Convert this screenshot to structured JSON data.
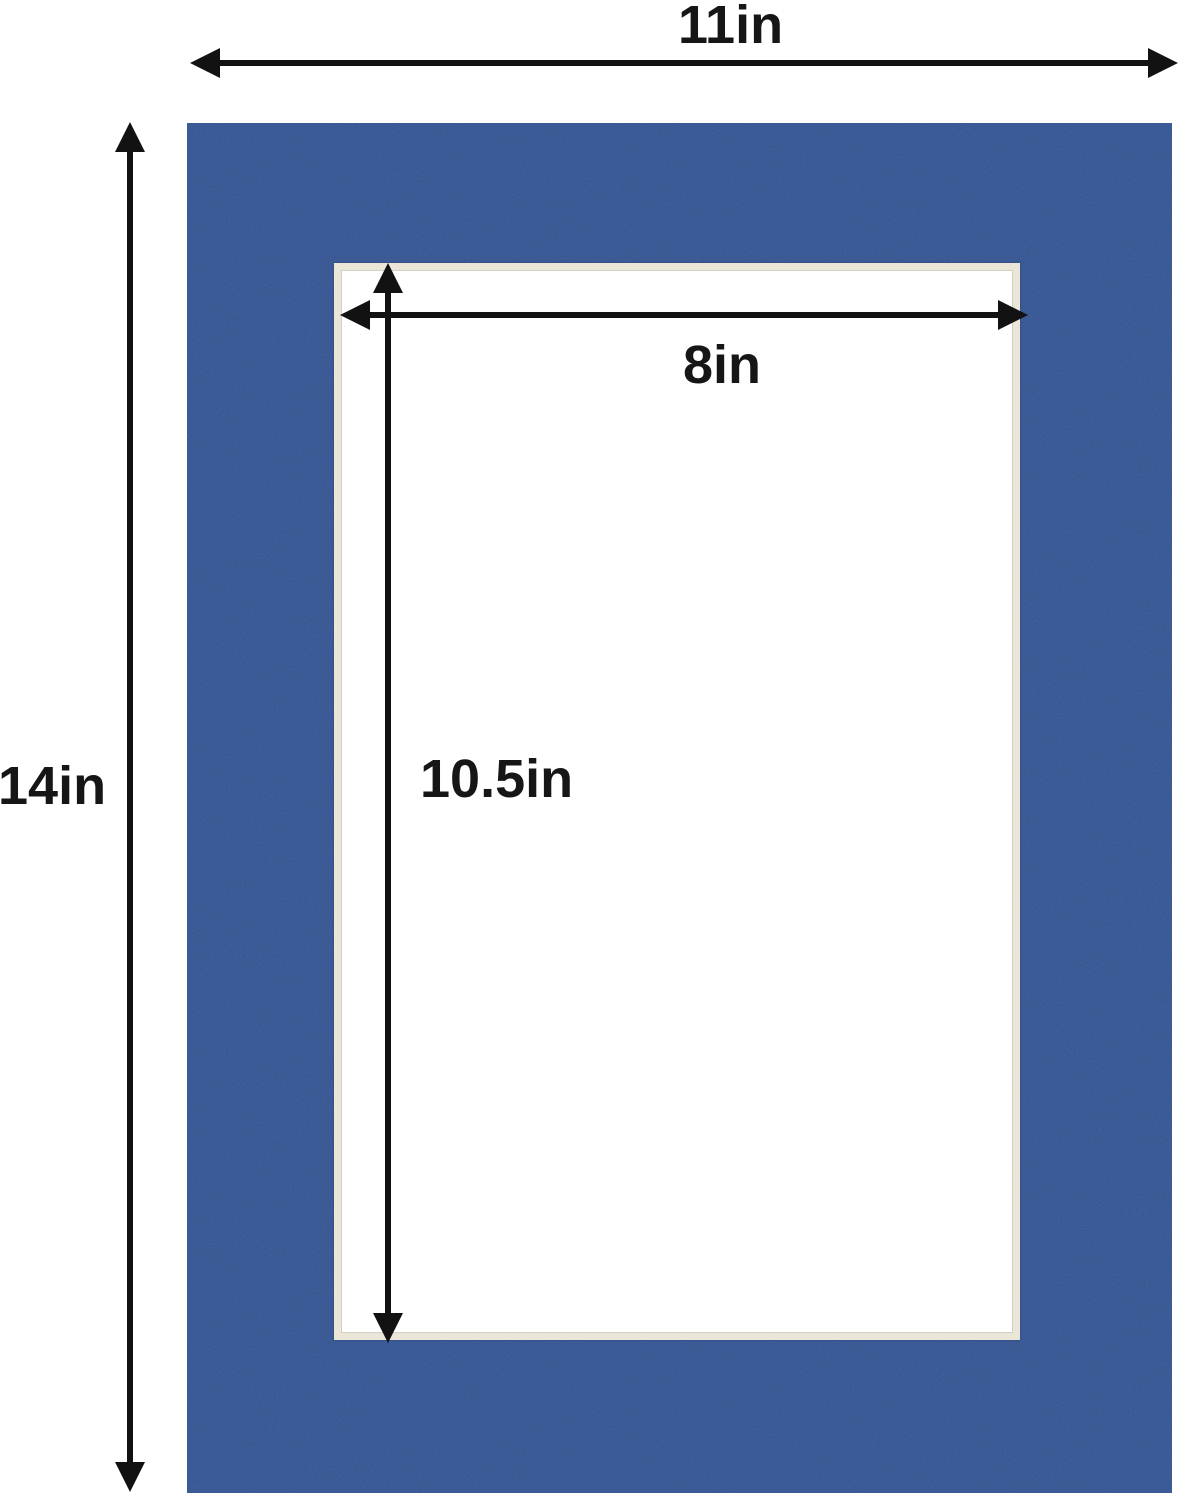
{
  "diagram": {
    "dimensions": {
      "outer_width": "11in",
      "outer_height": "14in",
      "opening_width": "8in",
      "opening_height": "10.5in"
    },
    "colors": {
      "mat_blue": "#2e4f8f",
      "bevel_cream": "#ebe6d7",
      "bevel_line_gray": "#d0cfc8",
      "opening_white": "#ffffff",
      "arrow_black": "#121212",
      "background_white": "#ffffff"
    }
  }
}
